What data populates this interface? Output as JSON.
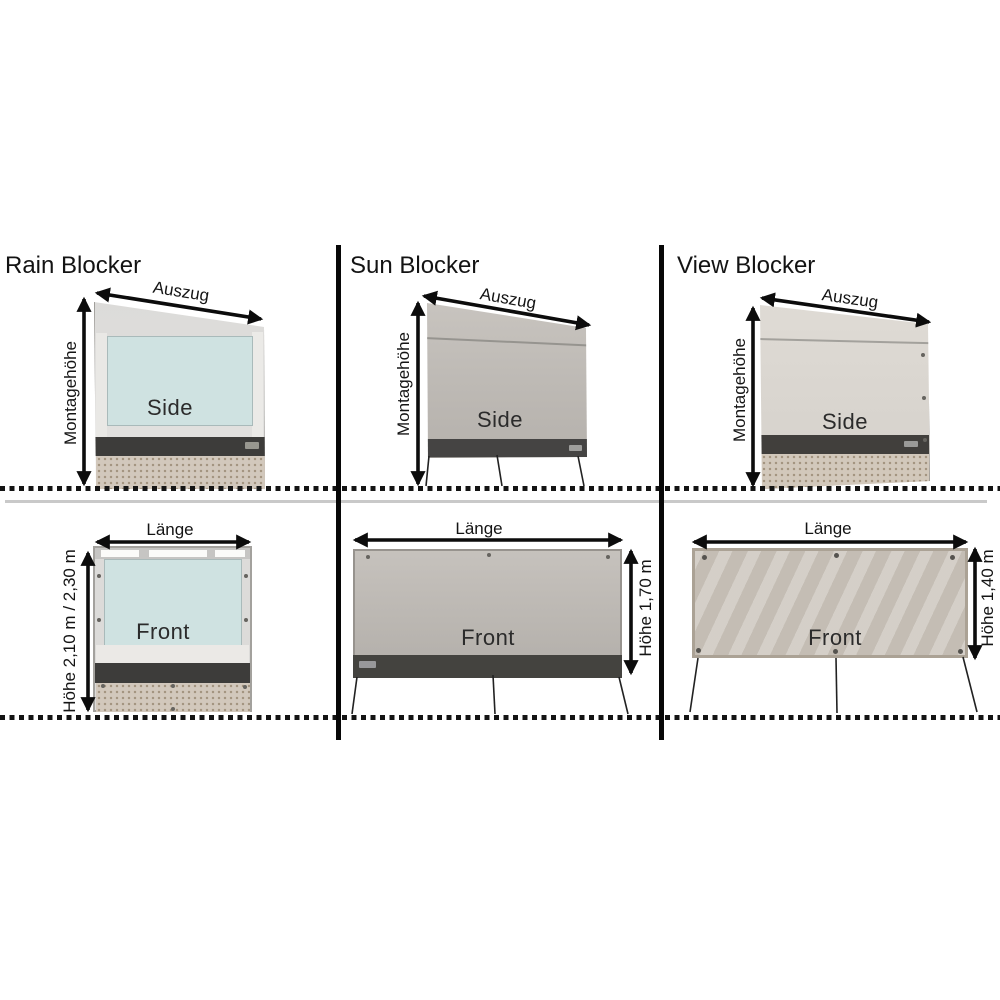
{
  "diagram": {
    "columns": [
      {
        "title": "Rain Blocker",
        "side_view": {
          "view_label": "Side",
          "extension_label": "Auszug",
          "mount_height_label": "Montagehöhe"
        },
        "front_view": {
          "view_label": "Front",
          "length_label": "Länge",
          "height_label": "Höhe 2,10 m / 2,30 m"
        }
      },
      {
        "title": "Sun Blocker",
        "side_view": {
          "view_label": "Side",
          "extension_label": "Auszug",
          "mount_height_label": "Montagehöhe"
        },
        "front_view": {
          "view_label": "Front",
          "length_label": "Länge",
          "height_label": "Höhe 1,70 m"
        }
      },
      {
        "title": "View Blocker",
        "side_view": {
          "view_label": "Side",
          "extension_label": "Auszug",
          "mount_height_label": "Montagehöhe"
        },
        "front_view": {
          "view_label": "Front",
          "length_label": "Länge",
          "height_label": "Höhe 1,40 m"
        }
      }
    ],
    "colors": {
      "divider_black": "#070707",
      "ground_dot_black": "#141414",
      "baseline_gray": "#c9c9c9",
      "rain_window_blue": "#cfe2e1",
      "panel_frame_gray": "#dcdbd9",
      "sun_fabric_gray": "#bcb8b3",
      "view_fabric_beige_gray": "#cac3ba",
      "dark_rail": "#3d3c3a",
      "skirt_beige": "#d2c8bc"
    }
  }
}
